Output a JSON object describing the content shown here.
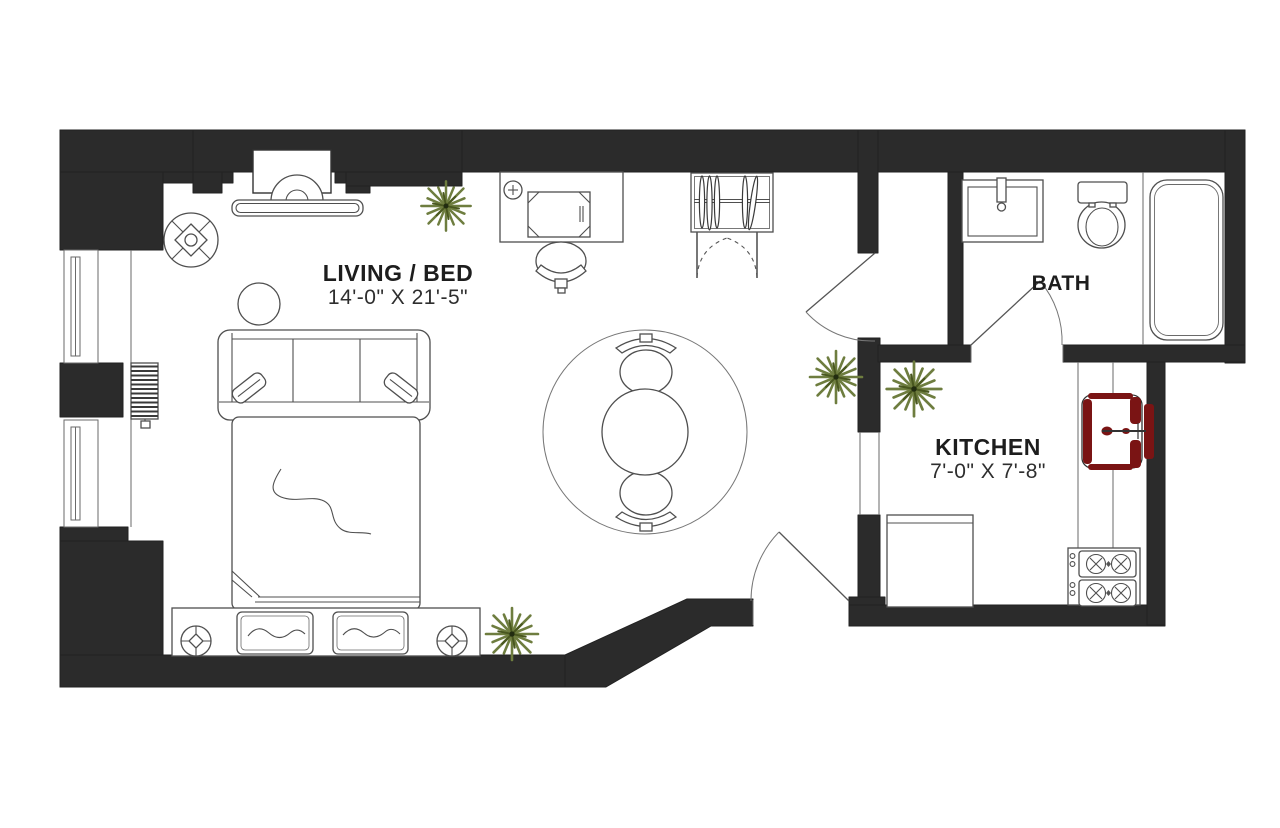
{
  "plan": {
    "title": "Studio apartment floor plan",
    "rooms": [
      {
        "id": "living-bed",
        "label": "LIVING / BED",
        "dimensions": "14'-0\" X 21'-5\""
      },
      {
        "id": "bath",
        "label": "BATH"
      },
      {
        "id": "kitchen",
        "label": "KITCHEN",
        "dimensions": "7'-0\" X 7'-8\""
      }
    ],
    "colors": {
      "wall": "#2b2b2b",
      "plant_leaf": "#6e7d3f",
      "plant_leaf_dark": "#49571f",
      "sink_accent": "#7a1414",
      "line": "#4f4f4f",
      "background": "#ffffff"
    },
    "fixtures": {
      "living_bed": [
        "fireplace",
        "armchair",
        "side-table",
        "sofa",
        "throw-pillows",
        "bed",
        "bed-pillows",
        "bedside-round-tables",
        "radiator",
        "window",
        "window",
        "desk",
        "desk-lamp",
        "laptop",
        "desk-chair",
        "closet-with-hangers",
        "round-rug",
        "round-table",
        "dining-chair",
        "dining-chair",
        "entry-door",
        "interior-door",
        "plant",
        "plant",
        "plant"
      ],
      "bath": [
        "vanity-sink",
        "toilet",
        "bathtub",
        "bath-door"
      ],
      "kitchen": [
        "kitchen-sink",
        "range-stove",
        "counter",
        "base-cabinet",
        "cased-opening",
        "plant"
      ]
    }
  }
}
